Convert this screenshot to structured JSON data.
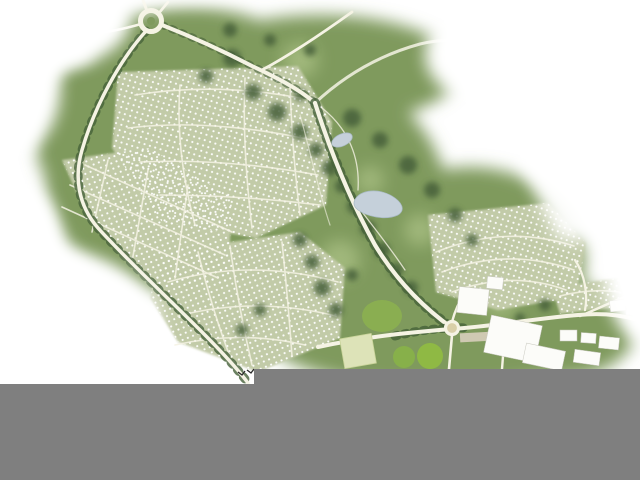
{
  "scene": {
    "kind": "aerial-master-plan-map",
    "description": "Painted aerial master plan of a residential community: roundabout at top left, tree-lined boulevard winding to a village center at lower right, housing clusters of small white homes, parkland with two ponds, commercial buildings and playfields; the bottom of the image is covered by a flat gray bar",
    "colors": {
      "background": "#ffffff",
      "footer_gray": "#7f7f7f",
      "park_green": "#7f9a5d",
      "park_light": "#a9bf83",
      "tree_dark": "#46613a",
      "housing_sage": "#c2cba8",
      "road_cream": "#f5f3e4",
      "pond_blue": "#c5d0da",
      "field_lime": "#8fb944",
      "building_white": "#fcfcf9"
    },
    "features": {
      "roundabout_count": 1,
      "pond_count": 2,
      "housing_cluster_count": 5,
      "village_center": "white commercial buildings and green playfields, lower right",
      "footer_bar": "solid gray block with a step, covering the bottom edge"
    }
  }
}
